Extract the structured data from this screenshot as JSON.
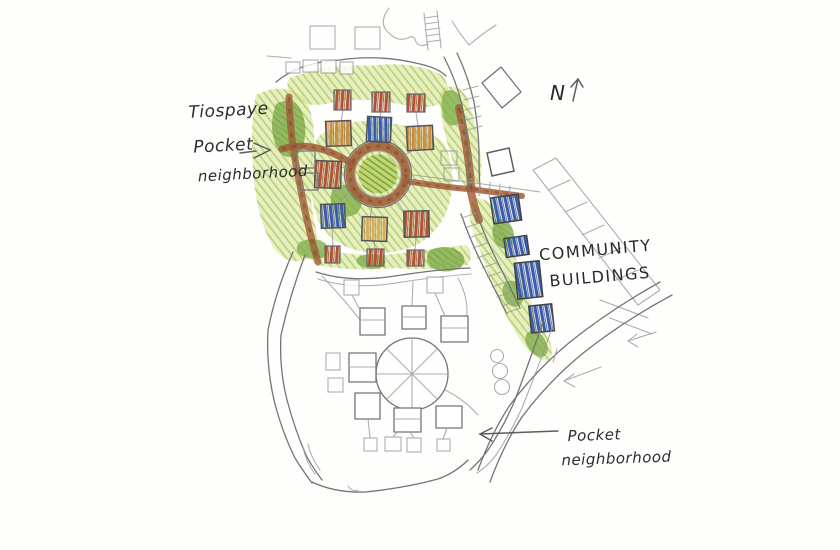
{
  "document": {
    "type": "hand-drawn site plan sketch"
  },
  "labels": {
    "tiospaye": {
      "lines": [
        "Tiospaye",
        "Pocket",
        "neighborhood"
      ]
    },
    "north_marker": "N",
    "community_buildings": {
      "lines": [
        "COMMUNITY",
        "BUILDINGS"
      ]
    },
    "pocket": {
      "lines": [
        "Pocket",
        "neighborhood"
      ]
    }
  },
  "palette": {
    "paper": "#fefefd",
    "pencil": "#747474",
    "ink_text": "#2d2d2d",
    "green_light": "#cfe187",
    "green_scribble": "#a8c455",
    "green_dark": "#7fae4a",
    "road_brown": "#a05c38",
    "house_orange": "#cd8d3e",
    "house_blue": "#3a5cad",
    "house_red": "#b35138",
    "house_tan": "#d9ae56"
  },
  "features": {
    "upper_courtyard": {
      "shape": "circular ring court",
      "ring_color": "#a05c38"
    },
    "upper_houses": {
      "count": 7,
      "colors": [
        "orange",
        "blue",
        "red",
        "tan"
      ]
    },
    "small_sheds": {
      "count": 6,
      "color": "red"
    },
    "community_buildings_colored": {
      "count": 4,
      "color": "#3a5cad"
    },
    "lower_houses": {
      "count": 7,
      "style": "pencil outline"
    },
    "lower_courtyard": {
      "shape": "circle with radial spokes"
    }
  }
}
